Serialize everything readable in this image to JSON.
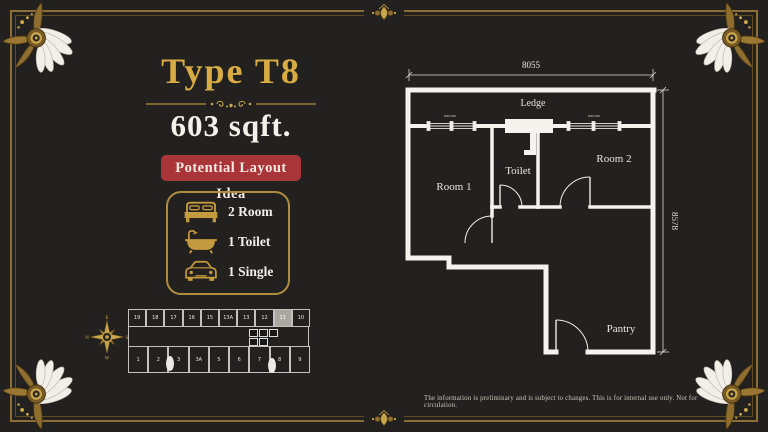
{
  "header": {
    "title": "Type T8",
    "area": "603 sqft.",
    "badge": "Potential Layout Idea"
  },
  "amenities": {
    "box_items": [
      {
        "icon": "bed-icon",
        "label": "2 Room"
      },
      {
        "icon": "bathtub-icon",
        "label": "1 Toilet"
      },
      {
        "icon": "car-icon",
        "label": "1 Single"
      }
    ]
  },
  "floorplan": {
    "dim_top": "8055",
    "dim_right": "8578",
    "labels": {
      "ledge": "Ledge",
      "room1": "Room 1",
      "toilet": "Toilet",
      "room2": "Room 2",
      "pantry": "Pantry"
    },
    "window_label": "600x500"
  },
  "keyplan": {
    "top_row": [
      "19",
      "18",
      "17",
      "16",
      "15",
      "13A",
      "13",
      "12",
      "11",
      "10"
    ],
    "bottom_row": [
      "1",
      "2",
      "3",
      "3A",
      "5",
      "6",
      "7",
      "8",
      "9"
    ],
    "highlighted_unit": "11",
    "compass": {
      "top": "E",
      "right": "S",
      "bottom": "W",
      "left": "N"
    }
  },
  "footer": {
    "disclaimer": "The information is preliminary and is subject to changes. This is for internal use only. Not for circulation."
  },
  "colors": {
    "background": "#23211f",
    "gold": "#c9a64b",
    "title_gold": "#d8ab45",
    "badge_red": "#a93538",
    "wall_white": "#f5f3ee"
  }
}
